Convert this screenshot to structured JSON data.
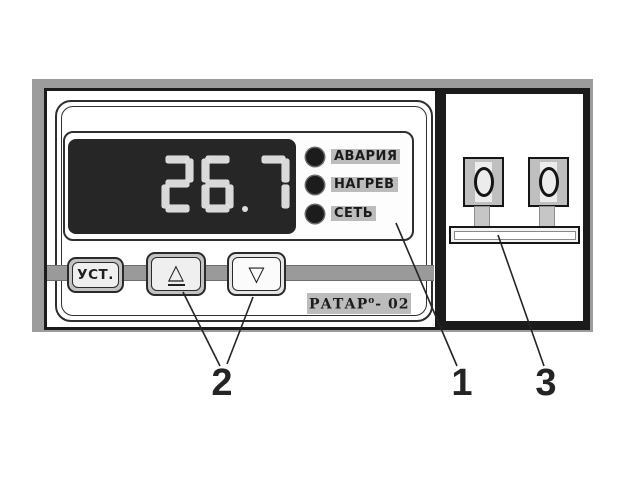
{
  "device": {
    "model_note": "front-panel diagram",
    "display": {
      "value": "26.7"
    },
    "leds": [
      {
        "label": "АВАРИЯ"
      },
      {
        "label": "НАГРЕВ"
      },
      {
        "label": "СЕТЬ"
      }
    ],
    "buttons": [
      {
        "name": "set",
        "label": "УСТ."
      },
      {
        "name": "up",
        "glyph": "△"
      },
      {
        "name": "down",
        "glyph": "▽"
      }
    ],
    "brand": {
      "name": "РАТАР",
      "sup": "о",
      "suffix": "- 02"
    },
    "terminals": {
      "count": 2
    }
  },
  "callouts": [
    {
      "number": "1"
    },
    {
      "number": "2"
    },
    {
      "number": "3"
    }
  ],
  "colors": {
    "frame": "#1b1b1b",
    "bevel": "#9c9c9c",
    "lcd": "#262626",
    "segment": "#d9d9d9",
    "led": "#1c1c1c",
    "labelbg": "#bcbcbc"
  }
}
